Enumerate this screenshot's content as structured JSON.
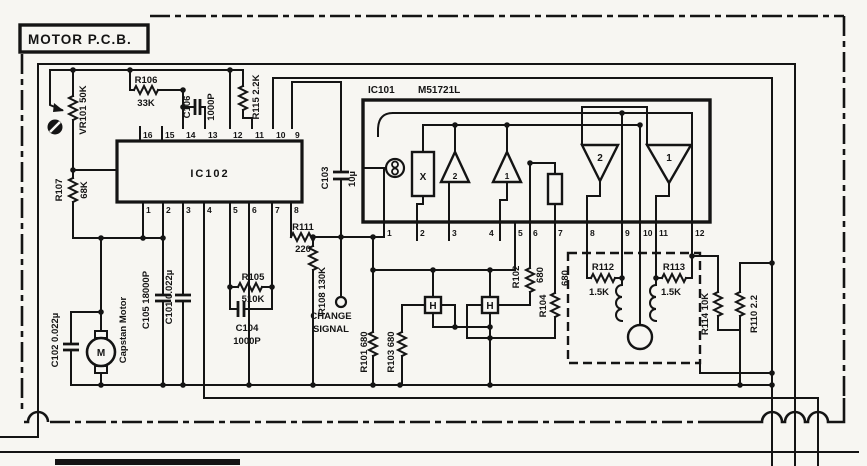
{
  "title": "MOTOR P.C.B.",
  "ic101": {
    "ref": "IC101",
    "part": "M51721L",
    "pins": [
      "1",
      "2",
      "3",
      "4",
      "5",
      "6",
      "7",
      "8",
      "9",
      "10",
      "11",
      "12"
    ],
    "amp_small_2": "2",
    "amp_small_1": "1",
    "amp_big_2": "2",
    "amp_big_1": "1",
    "mixer": "X"
  },
  "ic102": {
    "ref": "IC102",
    "pins_top": [
      "16",
      "15",
      "14",
      "13",
      "12",
      "11",
      "10",
      "9"
    ],
    "pins_bottom": [
      "1",
      "2",
      "3",
      "4",
      "5",
      "6",
      "7",
      "8"
    ]
  },
  "components": {
    "vr101": "VR101 50K",
    "r101": "R101 680",
    "r102": "R102",
    "r102_val": "680",
    "r103": "R103 680",
    "r104": "R104",
    "r104_val": "680",
    "r105": "R105",
    "r105_val": "510K",
    "r106": "R106",
    "r106_val": "33K",
    "r107": "R107",
    "r107_val": "68K",
    "r108": "R108 130K",
    "r110": "R110 2.2",
    "r111": "R111",
    "r111_val": "220",
    "r112": "R112",
    "r112_val": "1.5K",
    "r113": "R113",
    "r113_val": "1.5K",
    "r114": "R114 10K",
    "r115": "R115 2.2K",
    "c101": "C101 0.022µ",
    "c102": "C102 0.022µ",
    "c103": "C103",
    "c103_val": "10µ",
    "c104": "C104",
    "c104_val": "1000P",
    "c105": "C105 18000P",
    "c106": "C106",
    "c106_val": "1000P",
    "motor": "Capstan Motor",
    "motor_symbol": "M",
    "hall": "H",
    "change_signal_line1": "CHANGE",
    "change_signal_line2": "SIGNAL"
  }
}
